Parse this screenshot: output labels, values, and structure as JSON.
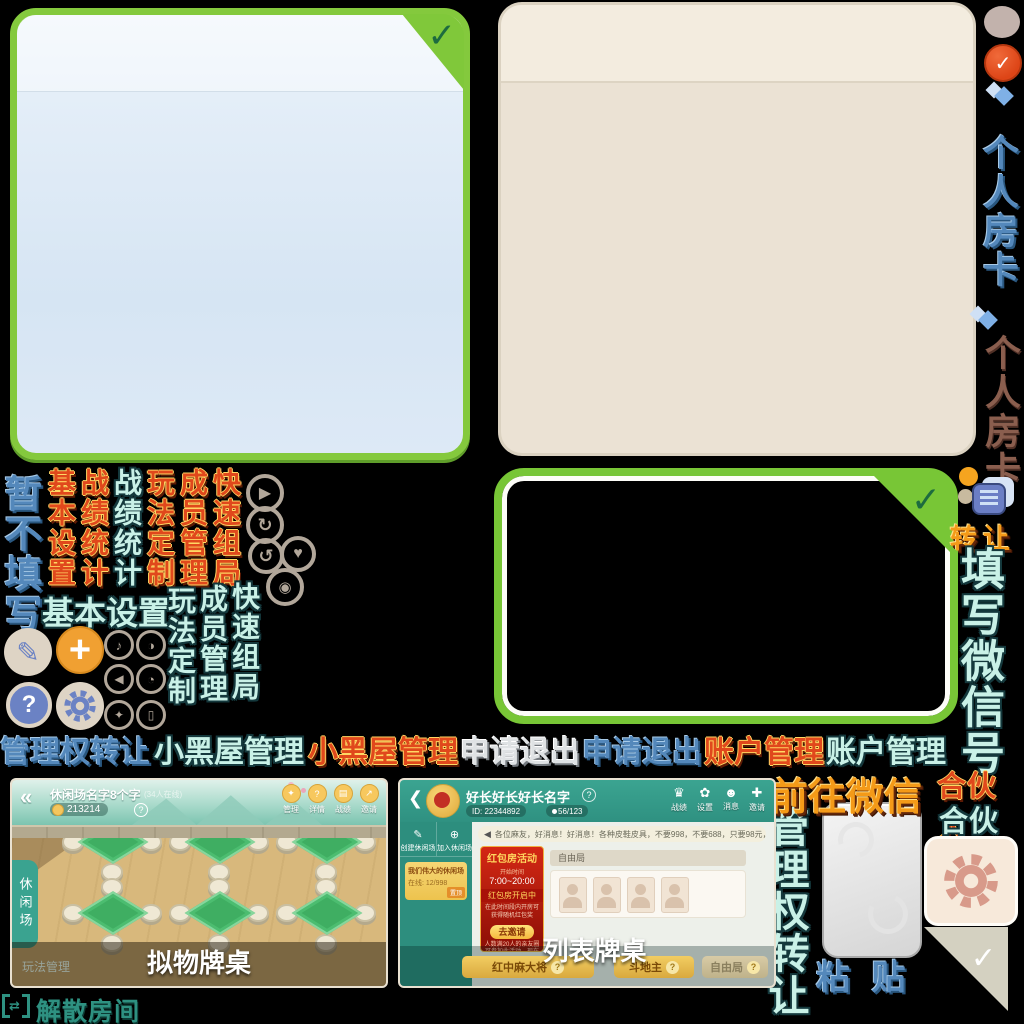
{
  "colors": {
    "panel_green": "#84c93d",
    "panel_blue_fill": "#dbe9f6",
    "panel_beige": "#ebe2d4",
    "accent_orange": "#f0a032",
    "teal": "#2f9181",
    "cyan_text": "#c9f1e7",
    "red_text": "#e0481c",
    "blue_text": "#5488bb",
    "salmon_gear": "#d89a8a"
  },
  "glyphs": {
    "check": "✓",
    "play": "▶",
    "history": "↻",
    "replay": "↺",
    "heart": "♥",
    "counter": "◉",
    "music": "♪",
    "contrast": "◑",
    "horn": "◀",
    "dial": "◔",
    "key": "✦",
    "exit": "▯",
    "pencil": "✎",
    "plus": "+",
    "question": "?",
    "back": "«",
    "speaker": "◀",
    "a_manage": "✦",
    "a_detail": "?",
    "a_record": "▤",
    "a_invite": "↗",
    "b_record": "♛",
    "b_setting": "✿",
    "b_message": "☻",
    "b_invite": "✚",
    "transfer_swap": "⇄"
  },
  "right_rail": {
    "personal_room_card_blue": "个人房卡",
    "personal_room_card_brown": "个人房卡",
    "transfer": "转让",
    "fill_wechat": "填写微信号",
    "partner_red": "合伙人",
    "partner_cyan": "合伙人",
    "goto_wechat": "前往微信",
    "management_transfer": "管理权转让",
    "paste": "粘 贴"
  },
  "menu_row": {
    "management_transfer_blue": "管理权转让",
    "blackroom_cyan": "小黑屋管理",
    "blackroom_red": "小黑屋管理",
    "quit_silver": "申请退出",
    "quit_blue": "申请退出",
    "account_red": "账户管理",
    "account_cyan": "账户管理"
  },
  "left_menus": {
    "skip_fill": "暂不填写",
    "columns_top": [
      "基本设置",
      "战绩统计",
      "战绩统计",
      "玩法定制",
      "成员管理",
      "快速组局"
    ],
    "basic_settings_h": "基本设置",
    "columns_bottom": [
      "玩法定制",
      "成员管理",
      "快速组局"
    ]
  },
  "screenshot_a": {
    "title": "休闲场名字8个字",
    "online": "(34人在线)",
    "room_id": "213214",
    "help": "?",
    "header_buttons": [
      "管理",
      "详情",
      "战绩",
      "邀请"
    ],
    "side_tab": "休闲场",
    "footer_left": "玩法管理",
    "caption": "拟物牌桌"
  },
  "screenshot_b": {
    "title": "好长好长好长名字",
    "id": "ID: 22344892",
    "members": "56/123",
    "header_buttons": [
      "战绩",
      "设置",
      "消息",
      "邀请"
    ],
    "create_btn": "创建休闲场",
    "join_btn": "加入休闲场",
    "room_card": {
      "name": "我们伟大的休闲场",
      "online": "在线: 12/998",
      "badge": "置顶"
    },
    "announcement": "各位麻友，好消息！好消息！各种皮鞋皮具，不要998，不要688，只要98元，只要9",
    "promo": {
      "title": "红包房活动",
      "time_label": "开始时间",
      "time": "7:00~20:00",
      "status": "红包房开启中",
      "desc": "在此时间段内开房可获得随机红包奖",
      "button": "去邀请",
      "note": "人数满20人的亲友圈可参加此活动，现在只有13人不符合参与条件"
    },
    "free_label": "自由局",
    "bottom_buttons": [
      "红中麻大将",
      "斗地主",
      "自由局"
    ],
    "caption": "列表牌桌"
  },
  "dissolve": "解散房间"
}
